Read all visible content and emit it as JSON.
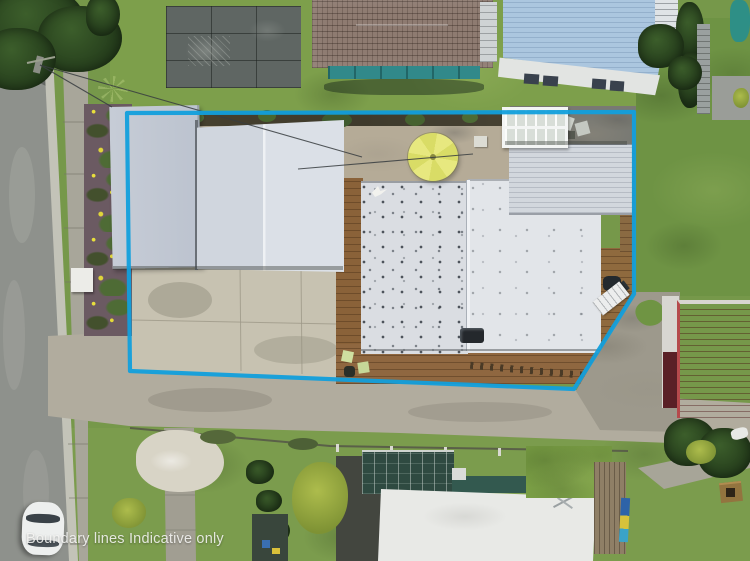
{
  "overlay": {
    "caption": "Boundary lines Indicative only"
  },
  "palette": {
    "boundary_line": "#129fdc",
    "caption": "#f3f3f1",
    "grass_base": "#76984a",
    "grass_bright": "#7d9f4b",
    "grass_right": "#6e9344",
    "roof_main_left": "#dadde2",
    "roof_main_right": "#e2e5e9",
    "roof_wing": "#d2d7dd",
    "roof_garage_left": "#c6ccd6",
    "roof_garage_right": "#d0d6de",
    "deck_wood": "#8a6239",
    "courtyard_dirt": "#b5ab97",
    "gravel_patio": "#83847d",
    "driveway_concrete": "#c7c2b1",
    "road_asphalt": "#8e918c",
    "footpath": "#a8a69a",
    "red_roof": "#9e3338",
    "maroon_door": "#5a2026",
    "blue_roof": "#abc6df",
    "skylight_roof": "#e2e4e2",
    "tile_roof": "#8e7b71",
    "teal_wall": "#31898a",
    "umbrella_yellow": "#e3e470",
    "dark_tree": "#2c4a22",
    "yellow_tree": "#98a93f",
    "asphalt_dark": "#43463f",
    "glasshouse_green": "#2f4a41",
    "neighbor_white_roof": "#e8e9e6",
    "car_white": "#edefee"
  }
}
